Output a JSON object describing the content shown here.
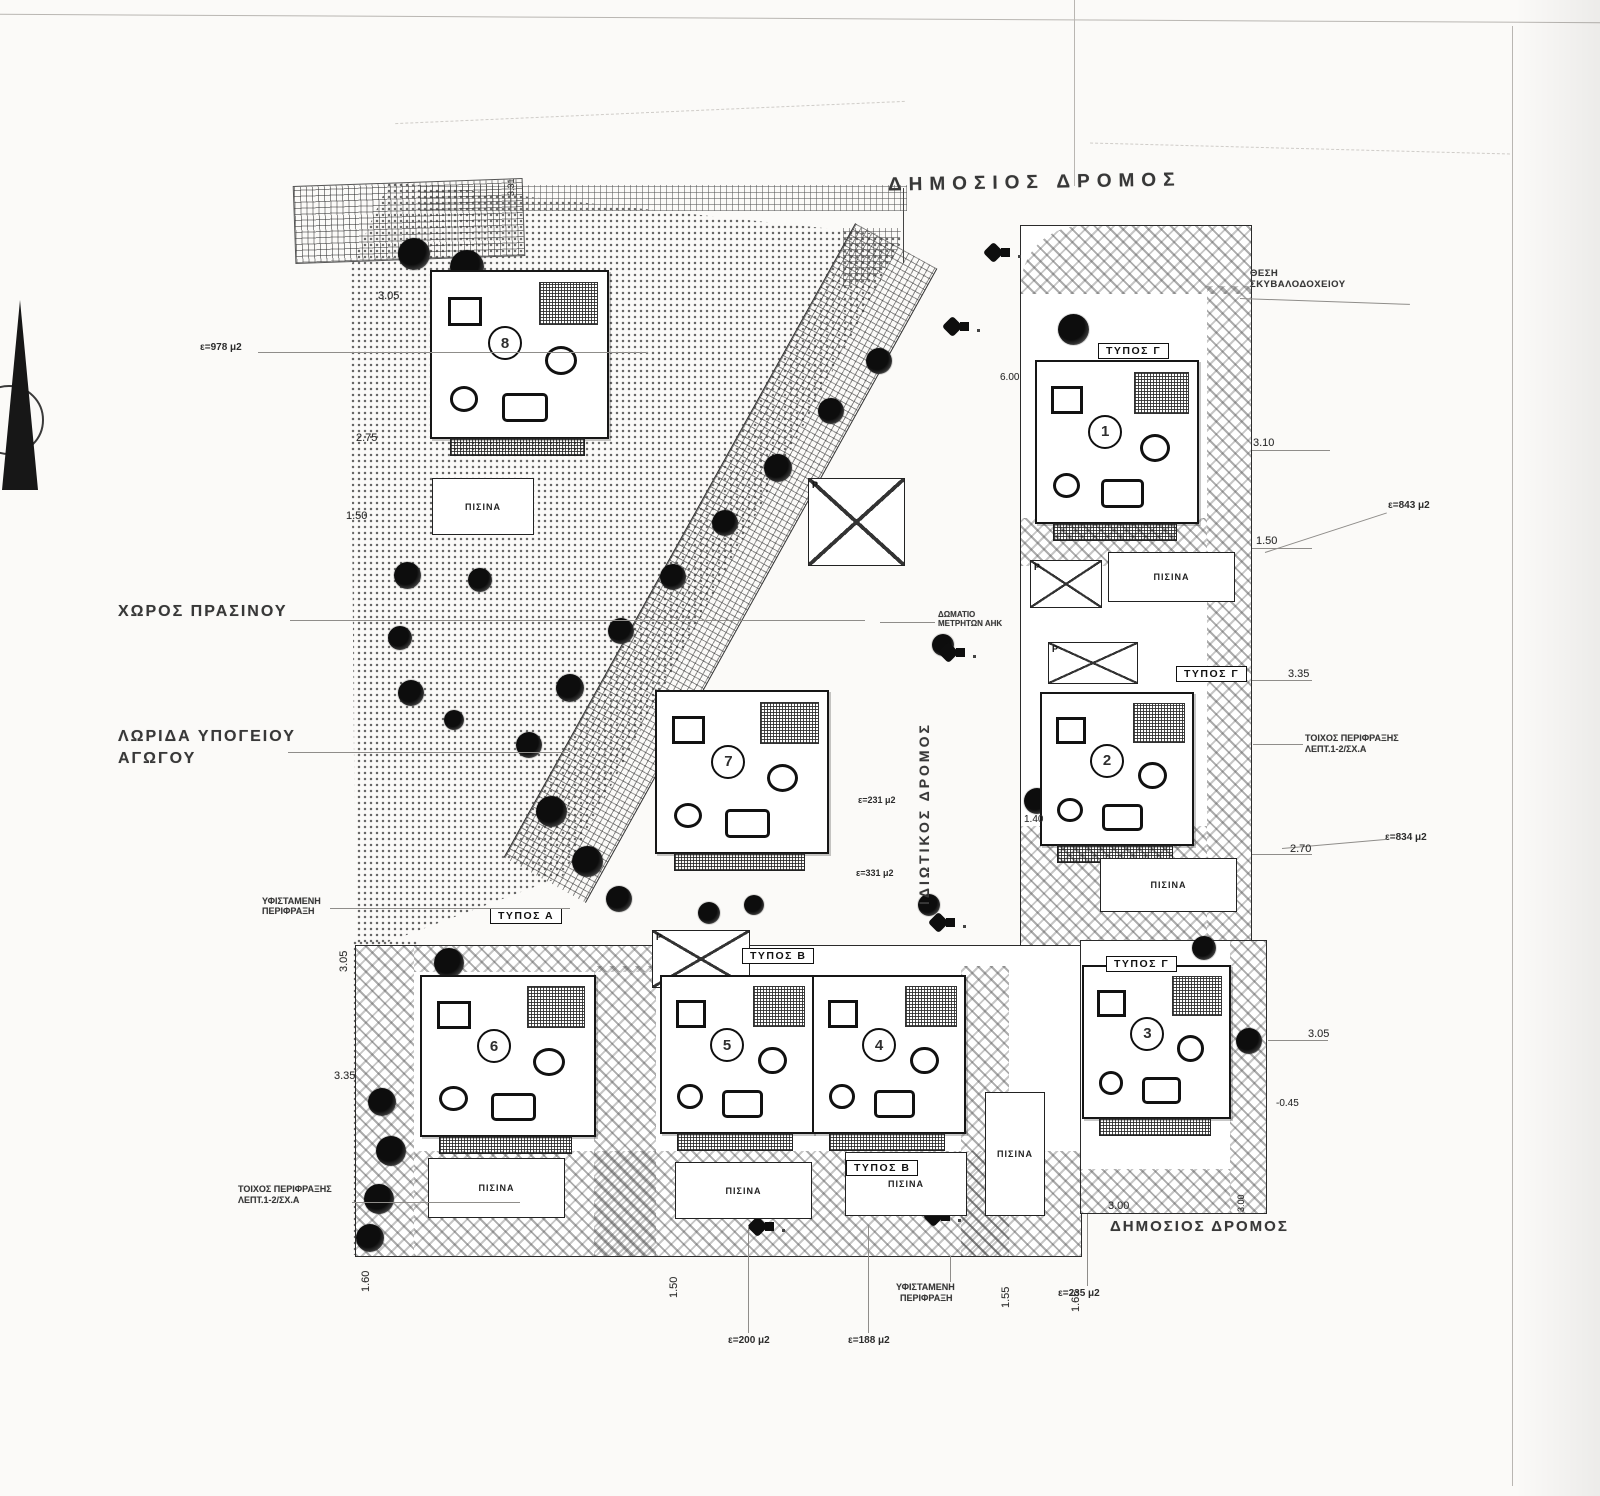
{
  "roads": {
    "public_top": "ΔΗΜΟΣΙΟΣ ΔΡΟΜΟΣ",
    "public_bottom": "ΔΗΜΟΣΙΟΣ ΔΡΟΜΟΣ",
    "private": "ΙΔΙΩΤΙΚΟΣ ΔΡΟΜΟΣ"
  },
  "labels": {
    "green_space": "ΧΩΡΟΣ ΠΡΑΣΙΝΟΥ",
    "pipe_strip_1": "ΛΩΡΙΔΑ ΥΠΟΓΕΙΟΥ",
    "pipe_strip_2": "ΑΓΩΓΟΥ",
    "bin_1": "ΘΕΣΗ",
    "bin_2": "ΣΚΥΒΑΛΟΔΟΧΕΙΟΥ",
    "meter_1": "ΔΩΜΑΤΙΟ",
    "meter_2": "ΜΕΤΡΗΤΩΝ ΑΗΚ",
    "fence_exist_1": "ΥΦΙΣΤΑΜΕΝΗ",
    "fence_exist_2": "ΠΕΡΙΦΡΑΞΗ",
    "fence_wall_1": "ΤΟΙΧΟΣ ΠΕΡΙΦΡΑΞΗΣ",
    "fence_wall_2": "ΛΕΠΤ.1-2/ΣΧ.Α",
    "pool": "ΠΙΣΙΝΑ",
    "parking": "P"
  },
  "types": {
    "a": "ΤΥΠΟΣ Α",
    "b": "ΤΥΠΟΣ Β",
    "c": "ΤΥΠΟΣ Γ"
  },
  "buildings": [
    {
      "number": "1"
    },
    {
      "number": "2"
    },
    {
      "number": "3"
    },
    {
      "number": "4"
    },
    {
      "number": "5"
    },
    {
      "number": "6"
    },
    {
      "number": "7"
    },
    {
      "number": "8"
    }
  ],
  "dimensions": {
    "left_top": "3.05",
    "left_mid": "2.75",
    "left_low": "1.50",
    "left_vert": "3.05",
    "left_335": "3.35",
    "top_331": "3.31",
    "right_310": "3.10",
    "right_150": "1.50",
    "right_335": "3.35",
    "right_270": "2.70",
    "right_305": "3.05",
    "right_045": "-0.45",
    "bottom_300": "3.00",
    "bottom_300v": "3.00",
    "b160": "1.60",
    "b150": "1.50",
    "b155": "1.55",
    "b165": "1.65",
    "road_140": "1.40",
    "road_600": "6.00"
  },
  "areas": {
    "a978": "ε=978 μ2",
    "a843": "ε=843 μ2",
    "a834": "ε=834 μ2",
    "a231": "ε=231 μ2",
    "a331": "ε=331 μ2",
    "a235": "ε=235 μ2",
    "a200": "ε=200 μ2",
    "a188": "ε=188 μ2"
  }
}
